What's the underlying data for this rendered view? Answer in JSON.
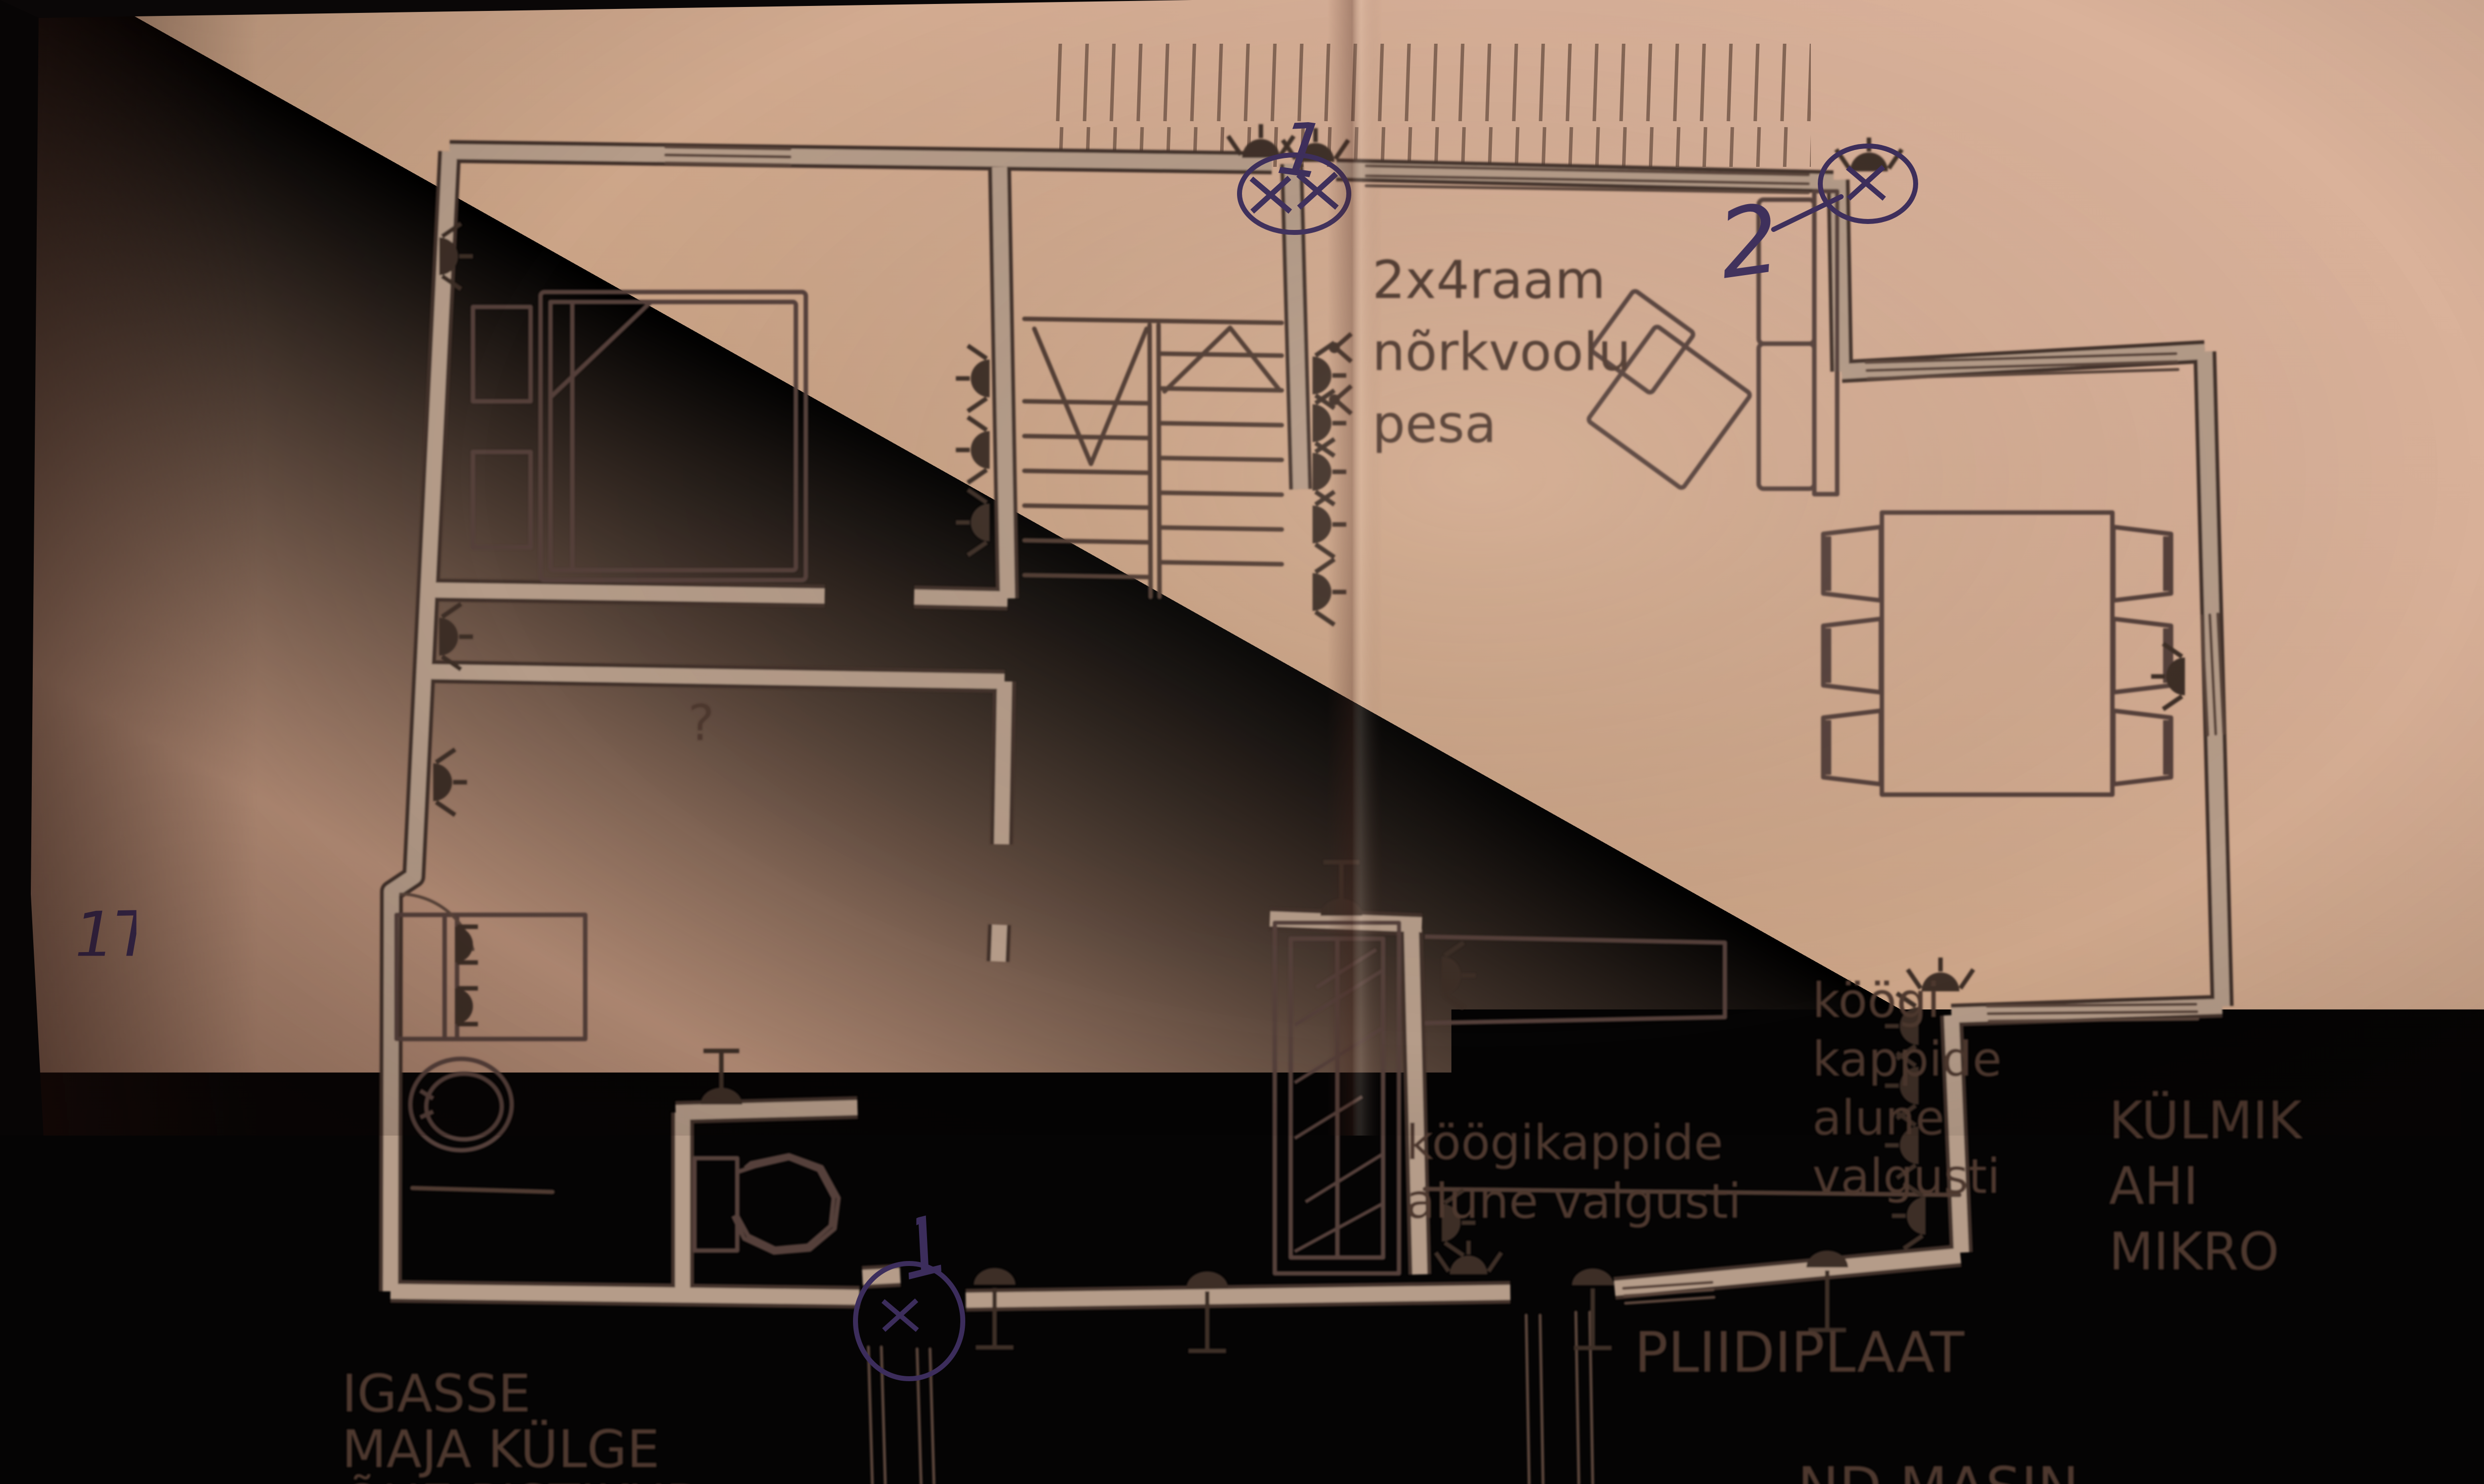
{
  "photo": {
    "description": "photo of a paper floor plan with electrical markings",
    "colors": {
      "background_black": "#060404",
      "paper_light": "#d8b098",
      "paper_mid": "#c39d86",
      "paper_dark": "#7e5c4b",
      "plan_ink": "#4a362e",
      "wall_fill": "#b59c89",
      "printed_text": "#4e382e",
      "pen_ink": "#3c2d5c"
    }
  },
  "plan": {
    "printed_labels": {
      "frame_note": [
        "2x4raam",
        "nõrkvoolu",
        "pesa"
      ],
      "unknown_room": "?",
      "kitchen_light_note_left": [
        "köögikappide",
        "alune valgusti"
      ],
      "kitchen_light_note_right": [
        "köögi",
        "kappide",
        "alune",
        "valgusti"
      ],
      "appliance_note": [
        "KÜLMIK",
        "AHI",
        "MIKRO"
      ],
      "stove_note": "PLIIDIPLAAT",
      "outdoor_note": [
        "IGASSE",
        "MAJA KÜLGE",
        "ÕUE PISTIKUD"
      ],
      "dishwasher_note": "ND MASIN"
    },
    "handwritten": {
      "mark_top_count": "1",
      "mark_sofa_corner_count": "2",
      "mark_entry_count": "1",
      "mark_kitchen_door_count": "2",
      "note_socket_types": [
        "1TÖÖSTUS",
        "1TAVAINE"
      ]
    },
    "icon_legend": {
      "socket": "wall socket symbol (filled half circle with rays)",
      "lamp": "wall lamp symbol (filled half oval with stem)",
      "switch": "switch chevron symbol",
      "xmark": "blue pen cross-out mark"
    }
  }
}
